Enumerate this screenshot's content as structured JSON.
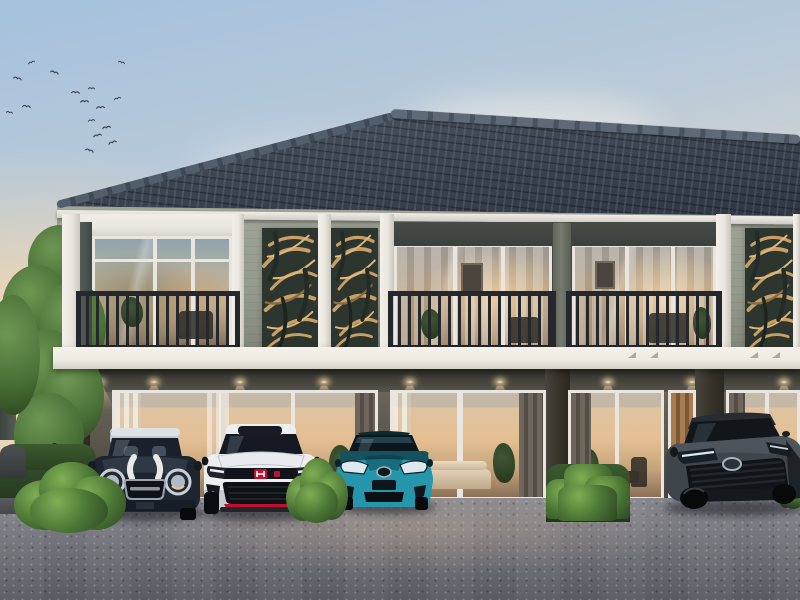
{
  "scene_type": "photorealistic exterior render: two-storey modern townhouse row at dawn with four cars parked in front",
  "colors": {
    "sky_top": "#a5c1dc",
    "sky_warm": "#f6e2c2",
    "roof_dark": "#3a4350",
    "roof_light": "#4d5663",
    "ridge": "#5f6a79",
    "wall_light": "#a0a598",
    "trim_white": "#e9e6df",
    "panel_bg": "#2c352e",
    "panel_leaf": "#c89f66",
    "railing": "#24282d",
    "header_dark": "#3b403d",
    "pillar_mid": "#767b70",
    "floor1_wall": "#5b564c",
    "soffit": "#56544b",
    "glass_warm": "#e4bf93",
    "band_white": "#efece4",
    "light_warm": "#ffe9c0",
    "asphalt_dark": "#595a62",
    "green_dark": "#2c4722",
    "green_mid": "#4a7434",
    "green_light": "#80ae54",
    "bird": "#3c4250",
    "car1_body": "#1d2530",
    "car1_roof": "#c6cbd1",
    "car2_body": "#eceef0",
    "car2_accent": "#bf1230",
    "car3_body": "#2596ab",
    "car4_body": "#3e454b"
  },
  "scene": {
    "building": {
      "storeys": 2,
      "roof": "dark grey tiled hip roof with ridge caps",
      "balconies": 3,
      "balcony_railing": "dark metal vertical balusters",
      "leaf_screen_panels": 3,
      "ground_glass_door_units": 4,
      "interior": "warm lit living rooms with curtains, sofas and plants",
      "downlight_count": 9
    },
    "cars": [
      {
        "id": "car-1",
        "style": "classic mini hatchback",
        "body_color": "dark navy black",
        "roof": "silver",
        "detail": "white bonnet stripes, round chrome headlights"
      },
      {
        "id": "car-2",
        "style": "sport hatchback",
        "body_color": "white",
        "detail": "black grille band, red maker badge, red front lip"
      },
      {
        "id": "car-3",
        "style": "hybrid hatchback",
        "body_color": "teal metallic",
        "detail": "angular headlights, maker badge"
      },
      {
        "id": "car-4",
        "style": "mid-size sedan, three-quarter view",
        "body_color": "dark grey",
        "detail": "wide slatted grille, slim headlights"
      }
    ],
    "vegetation": "tall green trees and hedge on the left, four trimmed shrubs along the driveway",
    "sky": "soft dawn sky, warm glow lower left, flock of birds upper left, faint clouds right",
    "birds": [
      [
        28,
        30
      ],
      [
        50,
        40
      ],
      [
        12,
        46
      ],
      [
        6,
        80
      ],
      [
        22,
        74
      ],
      [
        70,
        60
      ],
      [
        88,
        56
      ],
      [
        80,
        69
      ],
      [
        95,
        75
      ],
      [
        88,
        88
      ],
      [
        102,
        95
      ],
      [
        92,
        103
      ],
      [
        114,
        66
      ],
      [
        108,
        110
      ],
      [
        84,
        118
      ],
      [
        118,
        30
      ]
    ],
    "downlights_x": [
      96,
      150,
      236,
      320,
      406,
      496,
      604,
      688,
      780
    ],
    "leaf_screens": [
      {
        "x": 262,
        "y": 228,
        "w": 56,
        "h": 124
      },
      {
        "x": 331,
        "y": 228,
        "w": 47,
        "h": 124
      },
      {
        "x": 745,
        "y": 228,
        "w": 50,
        "h": 124
      }
    ],
    "pillars_floor2": [
      {
        "x": 62,
        "w": 18
      },
      {
        "x": 232,
        "w": 12
      },
      {
        "x": 318,
        "w": 13
      },
      {
        "x": 380,
        "w": 14
      },
      {
        "x": 716,
        "w": 15
      },
      {
        "x": 793,
        "w": 7
      }
    ],
    "vents_x": [
      628,
      650,
      750,
      772
    ],
    "bushes": [
      {
        "x": 14,
        "y": 462,
        "w": 112,
        "h": 72,
        "shape": "round",
        "front": true
      },
      {
        "x": 286,
        "y": 458,
        "w": 62,
        "h": 66,
        "shape": "round",
        "front": true
      },
      {
        "x": 546,
        "y": 464,
        "w": 84,
        "h": 58,
        "shape": "hedge",
        "front": true
      },
      {
        "x": 776,
        "y": 460,
        "w": 36,
        "h": 50,
        "shape": "round",
        "front": false
      }
    ]
  }
}
